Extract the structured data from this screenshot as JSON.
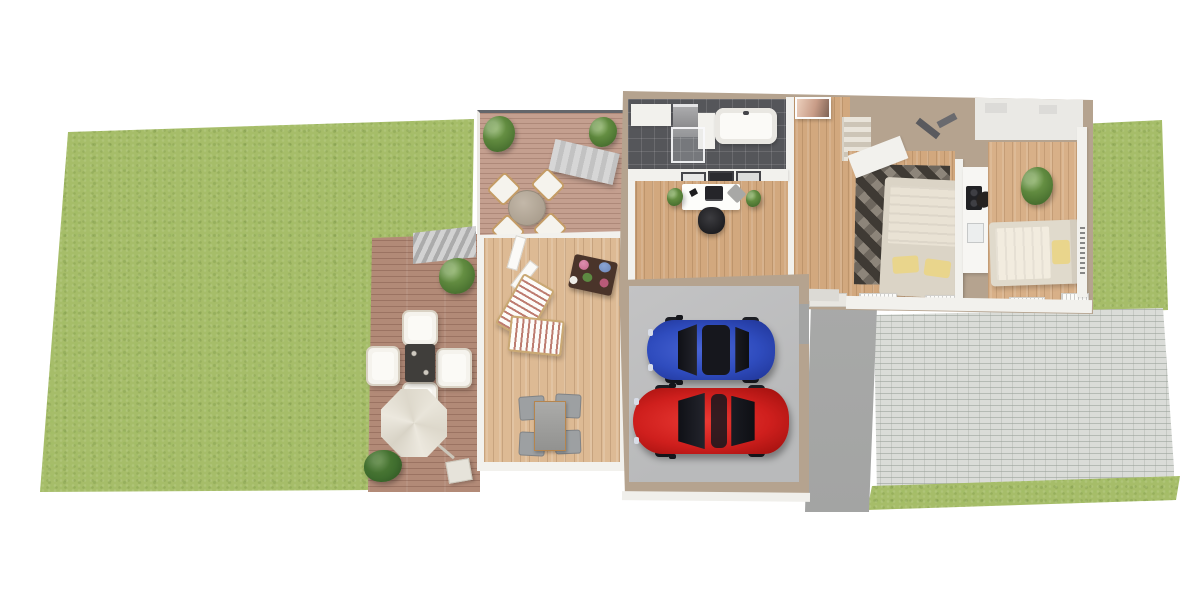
{
  "scene": {
    "kind": "3d-floor-plan-rendering",
    "description": "Top-down 3D architectural rendering of a single-storey home with garden, decks, garage with two cars and paved driveway",
    "visible_text": []
  },
  "palette": {
    "grass": "#a6bd69",
    "deck_wood": "#b28a77",
    "balcony_wood": "#c49f8f",
    "terrace_wood": "#ddba94",
    "interior_wood": "#d2a87e",
    "tile_dark": "#55565a",
    "wall_tan": "#b5a38f",
    "wall_white": "#f2f1ed",
    "garage_floor": "#b9babb",
    "walkway_gray": "#a3a4a3",
    "paver_gray": "#dadcd8",
    "car_blue": "#2f4cbe",
    "car_red": "#cf1f1d",
    "parasol_cream": "#e9e5da",
    "chair_white": "#f5f3ed",
    "stairs_gray": "#c2c2c2",
    "pillow_yellow": "#e9d58c",
    "plant_green": "#567f38",
    "rug_dark": "#3f3a34",
    "table_dark": "#403e3b"
  },
  "areas": [
    {
      "name": "left-lawn",
      "kind": "grass"
    },
    {
      "name": "lower-deck",
      "kind": "wood deck with lounge set and parasol"
    },
    {
      "name": "upper-balcony",
      "kind": "wood balcony with round dining set, two bushes, stairs"
    },
    {
      "name": "terrace-room",
      "kind": "enclosed terrace with loungers, flower table, dining set"
    },
    {
      "name": "bathroom",
      "kind": "dark tiled bathroom with tub, washer, shower"
    },
    {
      "name": "home-office",
      "kind": "office with desk, monitor, office chair, plants, wall frames"
    },
    {
      "name": "hallway",
      "kind": "entry hall with wall art, interior stairs, entrance door"
    },
    {
      "name": "bedroom-1",
      "kind": "bedroom with patterned rug, double bed, wardrobe, radiators"
    },
    {
      "name": "kitchenette",
      "kind": "counter strip with cooktop and sink"
    },
    {
      "name": "bedroom-2",
      "kind": "bedroom with bed, houseplant, radiators"
    },
    {
      "name": "garage",
      "kind": "garage with blue car and red car"
    },
    {
      "name": "entrance-walkway",
      "kind": "dark concrete path"
    },
    {
      "name": "driveway",
      "kind": "light paver driveway"
    },
    {
      "name": "right-lawn",
      "kind": "grass"
    },
    {
      "name": "bottom-grass-strip",
      "kind": "grass"
    }
  ],
  "vehicles": [
    {
      "name": "car-blue",
      "color_key": "car_blue",
      "orientation": "facing-left"
    },
    {
      "name": "car-red",
      "color_key": "car_red",
      "orientation": "facing-left"
    }
  ]
}
